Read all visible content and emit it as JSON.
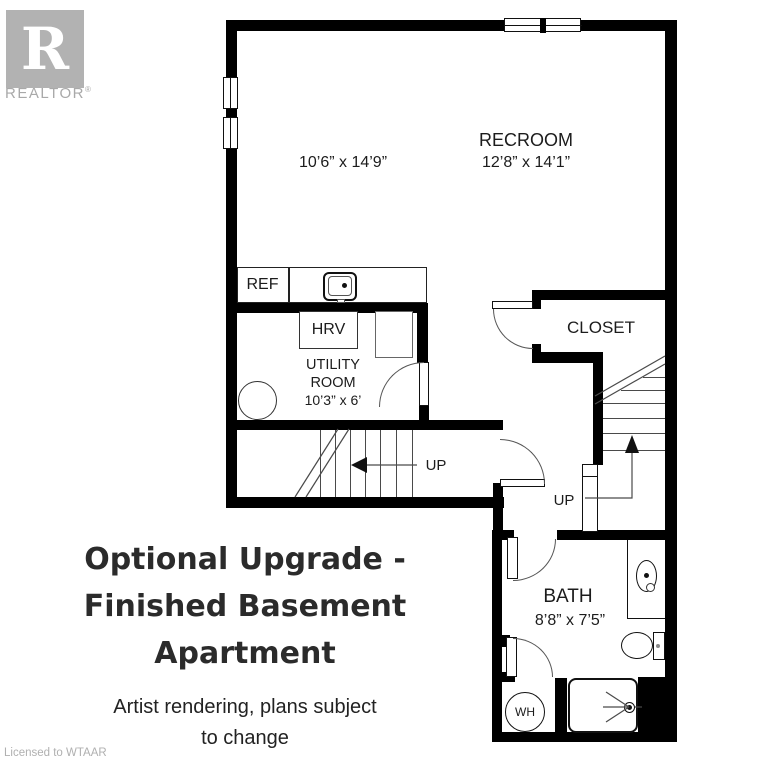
{
  "branding": {
    "logo_letter": "R",
    "logo_name": "REALTOR",
    "registered_mark": "®",
    "license": "Licensed to WTAAR"
  },
  "title": {
    "line1": "Optional Upgrade -",
    "line2": "Finished Basement",
    "line3": "Apartment",
    "subtitle_line1": "Artist rendering, plans subject",
    "subtitle_line2": "to change"
  },
  "rooms": {
    "left_room": {
      "dims": "10’6” x 14’9”"
    },
    "recroom": {
      "name": "RECROOM",
      "dims": "12’8” x 14’1”"
    },
    "utility": {
      "name_line1": "UTILITY",
      "name_line2": "ROOM",
      "dims": "10’3” x 6’"
    },
    "closet": {
      "name": "CLOSET"
    },
    "bath": {
      "name": "BATH",
      "dims": "8’8” x 7’5”"
    }
  },
  "labels": {
    "fridge": "REF",
    "hrv": "HRV",
    "water_heater": "WH",
    "stairs_up_hall": "UP",
    "stairs_up_landing": "UP"
  },
  "colors": {
    "wall": "#000000",
    "thin_line": "#4a4a4a",
    "logo_gray": "#b2b2b2",
    "title_text": "#2b2b2b"
  }
}
